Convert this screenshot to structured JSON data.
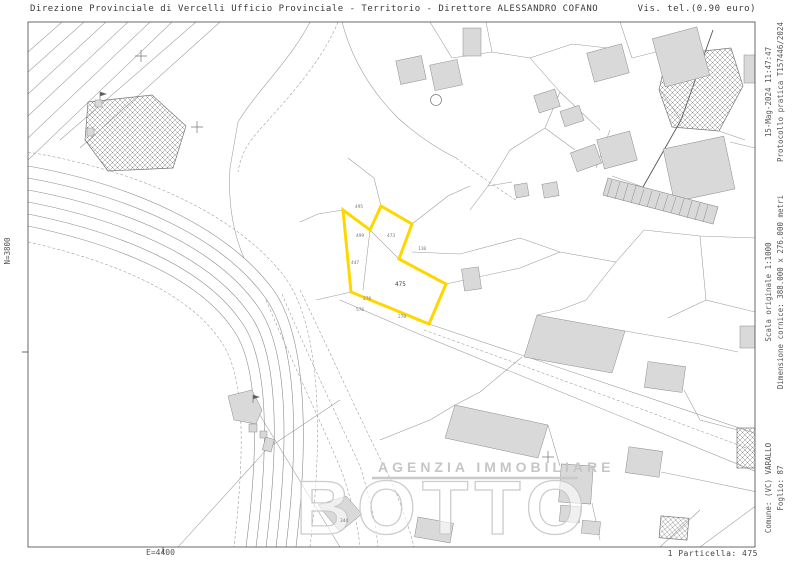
{
  "header": {
    "title_left": "Direzione Provinciale di Vercelli  Ufficio Provinciale - Territorio - Direttore ALESSANDRO COFANO",
    "title_right": "Vis. tel.(0.90 euro)"
  },
  "margins": {
    "left_coord": "N=3800",
    "bottom_coord": "E=4400",
    "right_top": [
      "15-Mag-2024 11:47:47",
      "Protocollo pratica T157446/2024"
    ],
    "right_middle": [
      "Scala originale 1:1000",
      "Dimensione cornice: 388.000 x 276.000 metri"
    ],
    "right_bottom": [
      "Comune: (VC) VARALLO",
      "Foglio: 87"
    ],
    "footer_right": "1 Particella: 475"
  },
  "watermark": {
    "agency_line": "AGENZIA IMMOBILIARE",
    "agency_name": "BOTTO"
  },
  "highlight": {
    "parcel_number": "475",
    "color": "#FFD700"
  },
  "parcel_labels": [
    {
      "text": "475"
    },
    {
      "text": "495"
    },
    {
      "text": "499"
    },
    {
      "text": "473"
    },
    {
      "text": "447"
    },
    {
      "text": "110"
    },
    {
      "text": "278"
    },
    {
      "text": "270"
    },
    {
      "text": "576"
    },
    {
      "text": "344"
    }
  ]
}
